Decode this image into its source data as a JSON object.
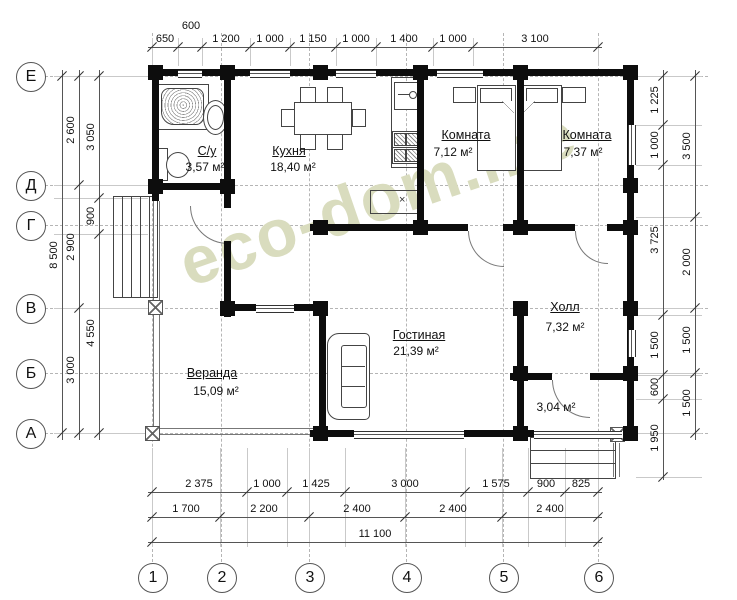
{
  "watermark": "eco-dom.me",
  "axes": {
    "rows": [
      "Е",
      "Д",
      "Г",
      "В",
      "Б",
      "А"
    ],
    "cols": [
      "1",
      "2",
      "3",
      "4",
      "5",
      "6"
    ]
  },
  "rooms": [
    {
      "name": "С/у",
      "area": "3,57 м²"
    },
    {
      "name": "Кухня",
      "area": "18,40 м²"
    },
    {
      "name": "Комната",
      "area": "7,12 м²"
    },
    {
      "name": "Комната",
      "area": "7,37 м²"
    },
    {
      "name": "Гостиная",
      "area": "21,39 м²"
    },
    {
      "name": "Холл",
      "area": "7,32 м²"
    },
    {
      "name": "Веранда",
      "area": "15,09 м²"
    },
    {
      "name": "",
      "area": "3,04 м²"
    }
  ],
  "dimensions": {
    "top": [
      "650",
      "600",
      "1 200",
      "1 000",
      "1 150",
      "1 000",
      "1 400",
      "1 000",
      "3 100"
    ],
    "left_outer": [
      "8 500"
    ],
    "left_mid": [
      "2 600",
      "2 900",
      "3 000"
    ],
    "left_inner": [
      "3 050",
      "900",
      "4 550"
    ],
    "right_inner": [
      "1 225",
      "1 000",
      "3 725",
      "1 500",
      "600",
      "1 950"
    ],
    "right_outer": [
      "3 500",
      "2 000",
      "1 500",
      "1 500"
    ],
    "bottom_first": [
      "2 375",
      "1 000",
      "1 425",
      "3 000",
      "1 575",
      "900",
      "825"
    ],
    "bottom_second": [
      "1 700",
      "2 200",
      "2 400",
      "2 400",
      "2 400"
    ],
    "bottom_total": [
      "11 100"
    ]
  },
  "symbols": {
    "boiler_mark": "×"
  }
}
